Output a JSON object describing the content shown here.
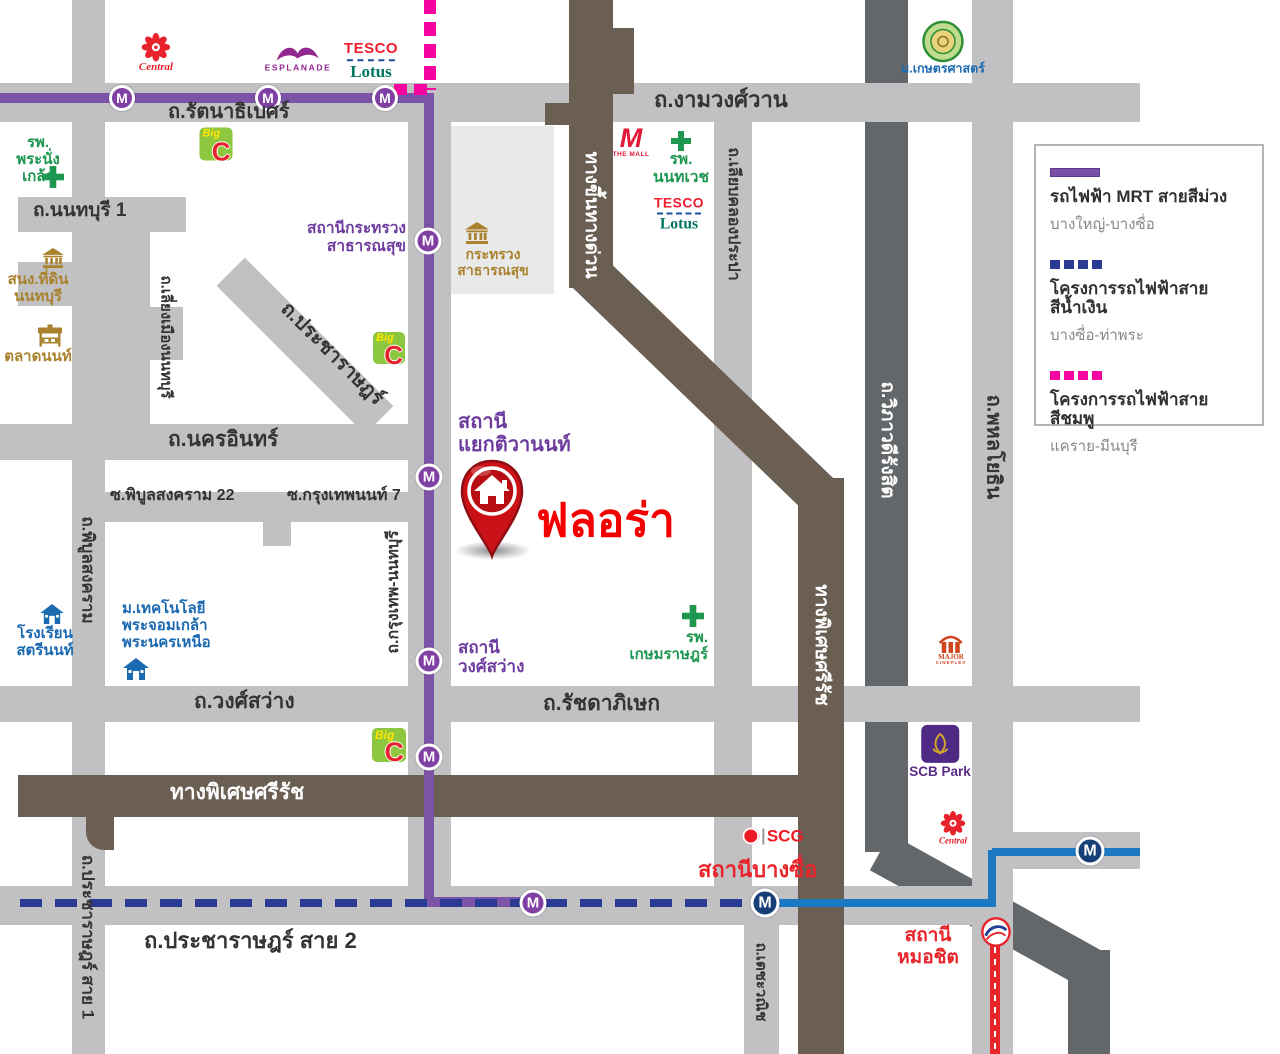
{
  "station_letter": "M",
  "pin": {
    "label": "ฟลอร่า"
  },
  "colors": {
    "road": "#c1c1c3",
    "road_dark": "#64676a",
    "expressway": "#6b5f54",
    "block": "#e9e9ea",
    "mrt_purple": "#7b53a7",
    "mrt_purple_station": "#7f3fa3",
    "pink": "#f5049f",
    "blue_project": "#2b3a92",
    "blue_line": "#1b79c3",
    "blue_station": "#173f77",
    "bts_red": "#e8232a",
    "white": "#ffffff",
    "dark": "#333335",
    "green": "#1e9750",
    "gold": "#a9822d",
    "purple": "#6d3c9e",
    "blue": "#1b69b1",
    "red": "#e8232a"
  },
  "legend": {
    "items": [
      {
        "swatch": "purple-solid-line",
        "title": "รถไฟฟ้า MRT สายสีม่วง",
        "sub": "บางใหญ่-บางซื่อ"
      },
      {
        "swatch": "blue-dashed-line",
        "title": "โครงการรถไฟฟ้าสายสีน้ำเงิน",
        "sub": "บางซื่อ-ท่าพระ"
      },
      {
        "swatch": "pink-dashed-line",
        "title": "โครงการรถไฟฟ้าสายสีชมพู",
        "sub": "แคราย-มีนบุรี"
      }
    ]
  },
  "roads": [
    {
      "n": "road-viphavadi-rangsit",
      "x": 865,
      "y": 0,
      "w": 43,
      "h": 852,
      "c": "road_dark"
    },
    {
      "n": "ramp-viphavadi-diagonal",
      "x": 865,
      "y": 889,
      "w": 240,
      "h": 42,
      "c": "road_dark",
      "rot": 29
    },
    {
      "n": "ramp-viphavadi-tail",
      "x": 1068,
      "y": 950,
      "w": 42,
      "h": 104,
      "c": "road_dark"
    },
    {
      "n": "block-ministry-compound",
      "x": 448,
      "y": 126,
      "w": 106,
      "h": 168,
      "c": "block"
    },
    {
      "n": "road-rattanathibet-ngamwongwan",
      "x": 0,
      "y": 83,
      "w": 1140,
      "h": 39,
      "c": "road"
    },
    {
      "n": "road-phibunsongkhram-pracharat1",
      "x": 72,
      "y": 0,
      "w": 33,
      "h": 1054,
      "c": "road"
    },
    {
      "n": "road-nonthaburi-1",
      "x": 18,
      "y": 197,
      "w": 168,
      "h": 35,
      "c": "road"
    },
    {
      "n": "road-liang-mueang",
      "x": 104,
      "y": 222,
      "w": 46,
      "h": 204,
      "c": "road"
    },
    {
      "n": "road-stub-west",
      "x": 18,
      "y": 262,
      "w": 132,
      "h": 44,
      "c": "road"
    },
    {
      "n": "road-stub-block",
      "x": 110,
      "y": 307,
      "w": 73,
      "h": 53,
      "c": "road"
    },
    {
      "n": "road-pracharat-diagonal",
      "x": 200,
      "y": 326,
      "w": 210,
      "h": 40,
      "c": "road",
      "rot": 45
    },
    {
      "n": "road-nakhon-in",
      "x": 0,
      "y": 424,
      "w": 432,
      "h": 36,
      "c": "road"
    },
    {
      "n": "road-soi-phibun22",
      "x": 72,
      "y": 492,
      "w": 345,
      "h": 30,
      "c": "road"
    },
    {
      "n": "road-soi-stub",
      "x": 263,
      "y": 520,
      "w": 28,
      "h": 26,
      "c": "road"
    },
    {
      "n": "road-wongsawang-ratchada",
      "x": 0,
      "y": 686,
      "w": 1140,
      "h": 36,
      "c": "road"
    },
    {
      "n": "road-pracharat-2",
      "x": 0,
      "y": 886,
      "w": 1013,
      "h": 39,
      "c": "road"
    },
    {
      "n": "road-krungthep-nonthaburi",
      "x": 408,
      "y": 118,
      "w": 43,
      "h": 807,
      "c": "road"
    },
    {
      "n": "road-liab-khlong-prapa",
      "x": 714,
      "y": 118,
      "w": 38,
      "h": 768,
      "c": "road"
    },
    {
      "n": "road-techawanit",
      "x": 744,
      "y": 925,
      "w": 35,
      "h": 129,
      "c": "road"
    },
    {
      "n": "road-phahonyothin",
      "x": 972,
      "y": 0,
      "w": 41,
      "h": 1054,
      "c": "road"
    },
    {
      "n": "road-east-spur",
      "x": 988,
      "y": 832,
      "w": 152,
      "h": 37,
      "c": "road"
    },
    {
      "n": "expressway-entry-vertical",
      "x": 569,
      "y": 0,
      "w": 44,
      "h": 288,
      "c": "expressway"
    },
    {
      "n": "expressway-arm-right",
      "x": 612,
      "y": 28,
      "w": 22,
      "h": 66,
      "c": "expressway"
    },
    {
      "n": "expressway-arm-left",
      "x": 545,
      "y": 103,
      "w": 30,
      "h": 22,
      "c": "expressway"
    },
    {
      "n": "expressway-diagonal",
      "x": 538,
      "y": 361,
      "w": 330,
      "h": 44,
      "c": "expressway",
      "rot": 44
    },
    {
      "n": "expressway-sirat-vertical",
      "x": 798,
      "y": 478,
      "w": 46,
      "h": 576,
      "c": "expressway"
    },
    {
      "n": "expressway-sirat-horizontal",
      "x": 18,
      "y": 775,
      "w": 826,
      "h": 42,
      "c": "expressway"
    },
    {
      "n": "expressway-hook",
      "x": 86,
      "y": 808,
      "w": 28,
      "h": 42,
      "c": "expressway",
      "rad": "0 0 0 18px"
    }
  ],
  "rails": [
    {
      "n": "mrt-purple-line-top",
      "x": 0,
      "y": 93,
      "w": 432,
      "h": 10,
      "c": "mrt_purple"
    },
    {
      "n": "mrt-purple-line-vertical",
      "x": 424,
      "y": 93,
      "w": 10,
      "h": 814,
      "c": "mrt_purple"
    },
    {
      "n": "mrt-purple-line-elbow",
      "x": 424,
      "y": 897,
      "w": 113,
      "h": 10,
      "c": "mrt_purple"
    },
    {
      "n": "pink-line-project-vertical",
      "x": 424,
      "y": 0,
      "w": 12,
      "h": 90,
      "c": "pink",
      "dash": [
        14,
        8
      ],
      "dir": "v"
    },
    {
      "n": "pink-line-project-horizontal",
      "x": 394,
      "y": 84,
      "w": 38,
      "h": 11,
      "c": "pink",
      "dash": [
        13,
        7
      ],
      "dir": "h"
    },
    {
      "n": "blue-line-project-dashed",
      "x": 20,
      "y": 899,
      "w": 748,
      "h": 8,
      "c": "blue_project",
      "dash": [
        22,
        13
      ],
      "dir": "h"
    },
    {
      "n": "blue-line-solid-1",
      "x": 765,
      "y": 899,
      "w": 231,
      "h": 8,
      "c": "blue_line"
    },
    {
      "n": "blue-line-solid-vertical",
      "x": 988,
      "y": 850,
      "w": 8,
      "h": 57,
      "c": "blue_line"
    },
    {
      "n": "blue-line-solid-2",
      "x": 992,
      "y": 848,
      "w": 148,
      "h": 8,
      "c": "blue_line"
    },
    {
      "n": "bts-red-line",
      "x": 990,
      "y": 944,
      "w": 10,
      "h": 110,
      "c": "bts_red"
    },
    {
      "n": "bts-red-line-center-dash",
      "x": 994,
      "y": 947,
      "w": 2,
      "h": 105,
      "c": "white",
      "dash": [
        6,
        6
      ],
      "dir": "v"
    }
  ],
  "stations": [
    {
      "n": "mrt-station",
      "x": 122,
      "y": 98,
      "d": 26,
      "k": "p"
    },
    {
      "n": "mrt-station",
      "x": 268,
      "y": 98,
      "d": 26,
      "k": "p"
    },
    {
      "n": "mrt-station",
      "x": 385,
      "y": 98,
      "d": 26,
      "k": "p"
    },
    {
      "n": "mrt-station-krasuang",
      "x": 428,
      "y": 241,
      "d": 27,
      "k": "p"
    },
    {
      "n": "mrt-station-tiwanon",
      "x": 429,
      "y": 477,
      "d": 27,
      "k": "p"
    },
    {
      "n": "mrt-station-wongsawang",
      "x": 429,
      "y": 661,
      "d": 27,
      "k": "p"
    },
    {
      "n": "mrt-station",
      "x": 429,
      "y": 757,
      "d": 27,
      "k": "p"
    },
    {
      "n": "mrt-station-taopoon",
      "x": 533,
      "y": 903,
      "d": 27,
      "k": "p"
    },
    {
      "n": "mrt-station-bangsue",
      "x": 765,
      "y": 903,
      "d": 29,
      "k": "b"
    },
    {
      "n": "mrt-station-east",
      "x": 1090,
      "y": 851,
      "d": 29,
      "k": "b"
    }
  ],
  "labels": [
    {
      "n": "road-label",
      "t": "ถ.รัตนาธิเบศร์",
      "x": 168,
      "y": 101,
      "fs": 20,
      "c": "dark"
    },
    {
      "n": "road-label",
      "t": "ถ.งามวงศ์วาน",
      "x": 654,
      "y": 87,
      "fs": 22,
      "c": "dark"
    },
    {
      "n": "road-label",
      "t": "ถ.นนทบุรี 1",
      "x": 33,
      "y": 200,
      "fs": 19,
      "c": "dark"
    },
    {
      "n": "road-label",
      "t": "ถ.นครอินทร์",
      "x": 168,
      "y": 428,
      "fs": 21,
      "c": "dark"
    },
    {
      "n": "road-label",
      "t": "ซ.พิบูลสงคราม 22",
      "x": 110,
      "y": 487,
      "fs": 16,
      "c": "dark"
    },
    {
      "n": "road-label",
      "t": "ซ.กรุงเทพนนท์ 7",
      "x": 287,
      "y": 487,
      "fs": 16,
      "c": "dark"
    },
    {
      "n": "road-label",
      "t": "ถ.วงศ์สว่าง",
      "x": 194,
      "y": 690,
      "fs": 21,
      "c": "dark"
    },
    {
      "n": "road-label",
      "t": "ถ.รัชดาภิเษก",
      "x": 543,
      "y": 692,
      "fs": 21,
      "c": "dark"
    },
    {
      "n": "road-label",
      "t": "ถ.ประชาราษฎร์ สาย 2",
      "x": 144,
      "y": 928,
      "fs": 22,
      "c": "dark"
    },
    {
      "n": "road-label",
      "t": "ถ.ประชาราษฎร์",
      "cx": 332,
      "cy": 354,
      "rot": 45,
      "fs": 20,
      "c": "dark"
    },
    {
      "n": "road-label",
      "t": "ถ.เลี่ยงเมืองนนทบุรี",
      "cx": 166,
      "cy": 337,
      "rot": 90,
      "fs": 15,
      "c": "dark"
    },
    {
      "n": "road-label",
      "t": "ถ.พิบูลสงคราม",
      "cx": 88,
      "cy": 570,
      "rot": 90,
      "fs": 17,
      "c": "dark"
    },
    {
      "n": "road-label",
      "t": "ถ.ประชาราษฎร์ สาย 1",
      "cx": 88,
      "cy": 937,
      "rot": 90,
      "fs": 17,
      "c": "dark"
    },
    {
      "n": "road-label",
      "t": "ถ.กรุงเทพ-นนทบุรี",
      "cx": 394,
      "cy": 592,
      "rot": -90,
      "fs": 16,
      "c": "dark"
    },
    {
      "n": "road-label",
      "t": "ถ.เลียบคลองประปา",
      "cx": 733,
      "cy": 214,
      "rot": 90,
      "fs": 16,
      "c": "dark"
    },
    {
      "n": "road-label",
      "t": "ถ.เตชะวณิช",
      "cx": 761,
      "cy": 982,
      "rot": 90,
      "fs": 15,
      "c": "dark"
    },
    {
      "n": "road-label",
      "t": "ถ.พหลโยธิน",
      "cx": 993,
      "cy": 447,
      "rot": 90,
      "fs": 20,
      "c": "dark"
    },
    {
      "n": "road-label",
      "t": "ถ.วิภาวดีรังสิต",
      "cx": 887,
      "cy": 440,
      "rot": 90,
      "fs": 19,
      "c": "white"
    },
    {
      "n": "expressway-label",
      "t": "ทางขึ้นทางด่วน",
      "cx": 591,
      "cy": 215,
      "rot": 90,
      "fs": 19,
      "c": "white"
    },
    {
      "n": "expressway-label",
      "t": "ทางพิเศษศรีรัช",
      "cx": 821,
      "cy": 645,
      "rot": 90,
      "fs": 19,
      "c": "white"
    },
    {
      "n": "expressway-label",
      "t": "ทางพิเศษศรีรัช",
      "x": 170,
      "y": 781,
      "fs": 21,
      "c": "white"
    },
    {
      "n": "hospital-label",
      "t": "รพ.\nพระนั่งเกล้า",
      "x": 2,
      "y": 134,
      "w": 72,
      "al": "center",
      "fs": 15,
      "c": "green"
    },
    {
      "n": "landoffice-label",
      "t": "สนง.ที่ดิน\nนนทบุรี",
      "x": 2,
      "y": 271,
      "w": 72,
      "al": "center",
      "fs": 15,
      "c": "gold"
    },
    {
      "n": "market-label",
      "t": "ตลาดนนท์",
      "x": 0,
      "y": 348,
      "w": 76,
      "al": "center",
      "fs": 15,
      "c": "gold"
    },
    {
      "n": "station-label",
      "t": "สถานีกระทรวง\nสาธารณสุข",
      "x": 286,
      "y": 220,
      "w": 120,
      "al": "right",
      "fs": 15.5,
      "c": "purple"
    },
    {
      "n": "ministry-label",
      "t": "กระทรวง\nสาธารณสุข",
      "x": 440,
      "y": 247,
      "w": 106,
      "al": "center",
      "fs": 14,
      "c": "gold"
    },
    {
      "n": "hospital-label",
      "t": "รพ.\nนนทเวช",
      "x": 640,
      "y": 151,
      "w": 82,
      "al": "center",
      "fs": 15.5,
      "c": "green"
    },
    {
      "n": "station-label",
      "t": "สถานี\nแยกติวานนท์",
      "x": 458,
      "y": 411,
      "fs": 20,
      "c": "purple"
    },
    {
      "n": "university-label",
      "t": "ม.เทคโนโลยี\nพระจอมเกล้า\nพระนครเหนือ",
      "x": 122,
      "y": 600,
      "fs": 15,
      "c": "blue"
    },
    {
      "n": "school-label",
      "t": "โรงเรียน\nสตรีนนท์",
      "x": 10,
      "y": 625,
      "w": 70,
      "al": "center",
      "fs": 15,
      "c": "blue"
    },
    {
      "n": "station-label",
      "t": "สถานี\nวงศ์สว่าง",
      "x": 458,
      "y": 638,
      "fs": 17,
      "c": "purple"
    },
    {
      "n": "hospital-label",
      "t": "รพ.\nเกษมราษฎร์",
      "x": 614,
      "y": 629,
      "w": 94,
      "al": "right",
      "fs": 15,
      "c": "green"
    },
    {
      "n": "station-label-bangsue",
      "t": "สถานีบางซื่อ",
      "x": 698,
      "y": 857,
      "fs": 22,
      "c": "red"
    },
    {
      "n": "station-label-mochit",
      "t": "สถานี\nหมอชิต",
      "x": 891,
      "y": 925,
      "w": 74,
      "al": "center",
      "fs": 19,
      "c": "red"
    }
  ],
  "landmarks": [
    {
      "type": "central",
      "n": "central-logo",
      "x": 156,
      "y": 53,
      "cap": "Central",
      "s": 1
    },
    {
      "type": "esplanade",
      "n": "esplanade-logo",
      "x": 298,
      "y": 58,
      "cap": "ESPLANADE"
    },
    {
      "type": "tesco",
      "n": "tesco-lotus-logo",
      "x": 371,
      "y": 61,
      "t1": "TESCO",
      "t2": "Lotus",
      "s": 1
    },
    {
      "type": "bigc",
      "n": "bigc-logo",
      "x": 216,
      "y": 144,
      "s": 33,
      "t1": "Big",
      "t2": "C"
    },
    {
      "type": "cross",
      "n": "hospital-cross-icon",
      "x": 53,
      "y": 177,
      "s": 22
    },
    {
      "type": "bank",
      "n": "government-building-icon",
      "x": 53,
      "y": 258,
      "s": 22
    },
    {
      "type": "market",
      "n": "market-icon",
      "x": 50,
      "y": 336,
      "s": 26
    },
    {
      "type": "bank",
      "n": "ministry-building-icon",
      "x": 477,
      "y": 233,
      "s": 24
    },
    {
      "type": "bigc",
      "n": "bigc-logo",
      "x": 389,
      "y": 348,
      "s": 32,
      "t1": "Big",
      "t2": "C"
    },
    {
      "type": "themall",
      "n": "the-mall-logo",
      "x": 631,
      "y": 142,
      "cap": "THE MALL"
    },
    {
      "type": "cross",
      "n": "hospital-cross-icon",
      "x": 681,
      "y": 141,
      "s": 20
    },
    {
      "type": "tesco",
      "n": "tesco-lotus-logo",
      "x": 679,
      "y": 215,
      "t1": "TESCO",
      "t2": "Lotus",
      "s": 0.92
    },
    {
      "type": "kasetsart",
      "n": "kasetsart-university-logo",
      "x": 943,
      "y": 48,
      "cap": "ม.เกษตรศาสตร์"
    },
    {
      "type": "school",
      "n": "school-icon",
      "x": 52,
      "y": 614,
      "s": 24
    },
    {
      "type": "school",
      "n": "university-icon",
      "x": 136,
      "y": 669,
      "s": 26
    },
    {
      "type": "cross",
      "n": "hospital-cross-icon",
      "x": 693,
      "y": 616,
      "s": 22
    },
    {
      "type": "bigc",
      "n": "bigc-logo",
      "x": 389,
      "y": 745,
      "s": 34,
      "t1": "Big",
      "t2": "C"
    },
    {
      "type": "scb",
      "n": "scb-park-logo",
      "x": 940,
      "y": 752,
      "cap": "SCB Park"
    },
    {
      "type": "central",
      "n": "central-logo",
      "x": 953,
      "y": 828,
      "cap": "Central",
      "s": 0.85
    },
    {
      "type": "major",
      "n": "major-cineplex-logo",
      "x": 951,
      "y": 650,
      "cap1": "MAJOR",
      "cap2": "CINEPLEX"
    },
    {
      "type": "scg",
      "n": "scg-logo",
      "x": 773,
      "y": 836,
      "t": "SCG"
    },
    {
      "type": "bts",
      "n": "bts-logo",
      "x": 996,
      "y": 932,
      "s": 32
    }
  ]
}
